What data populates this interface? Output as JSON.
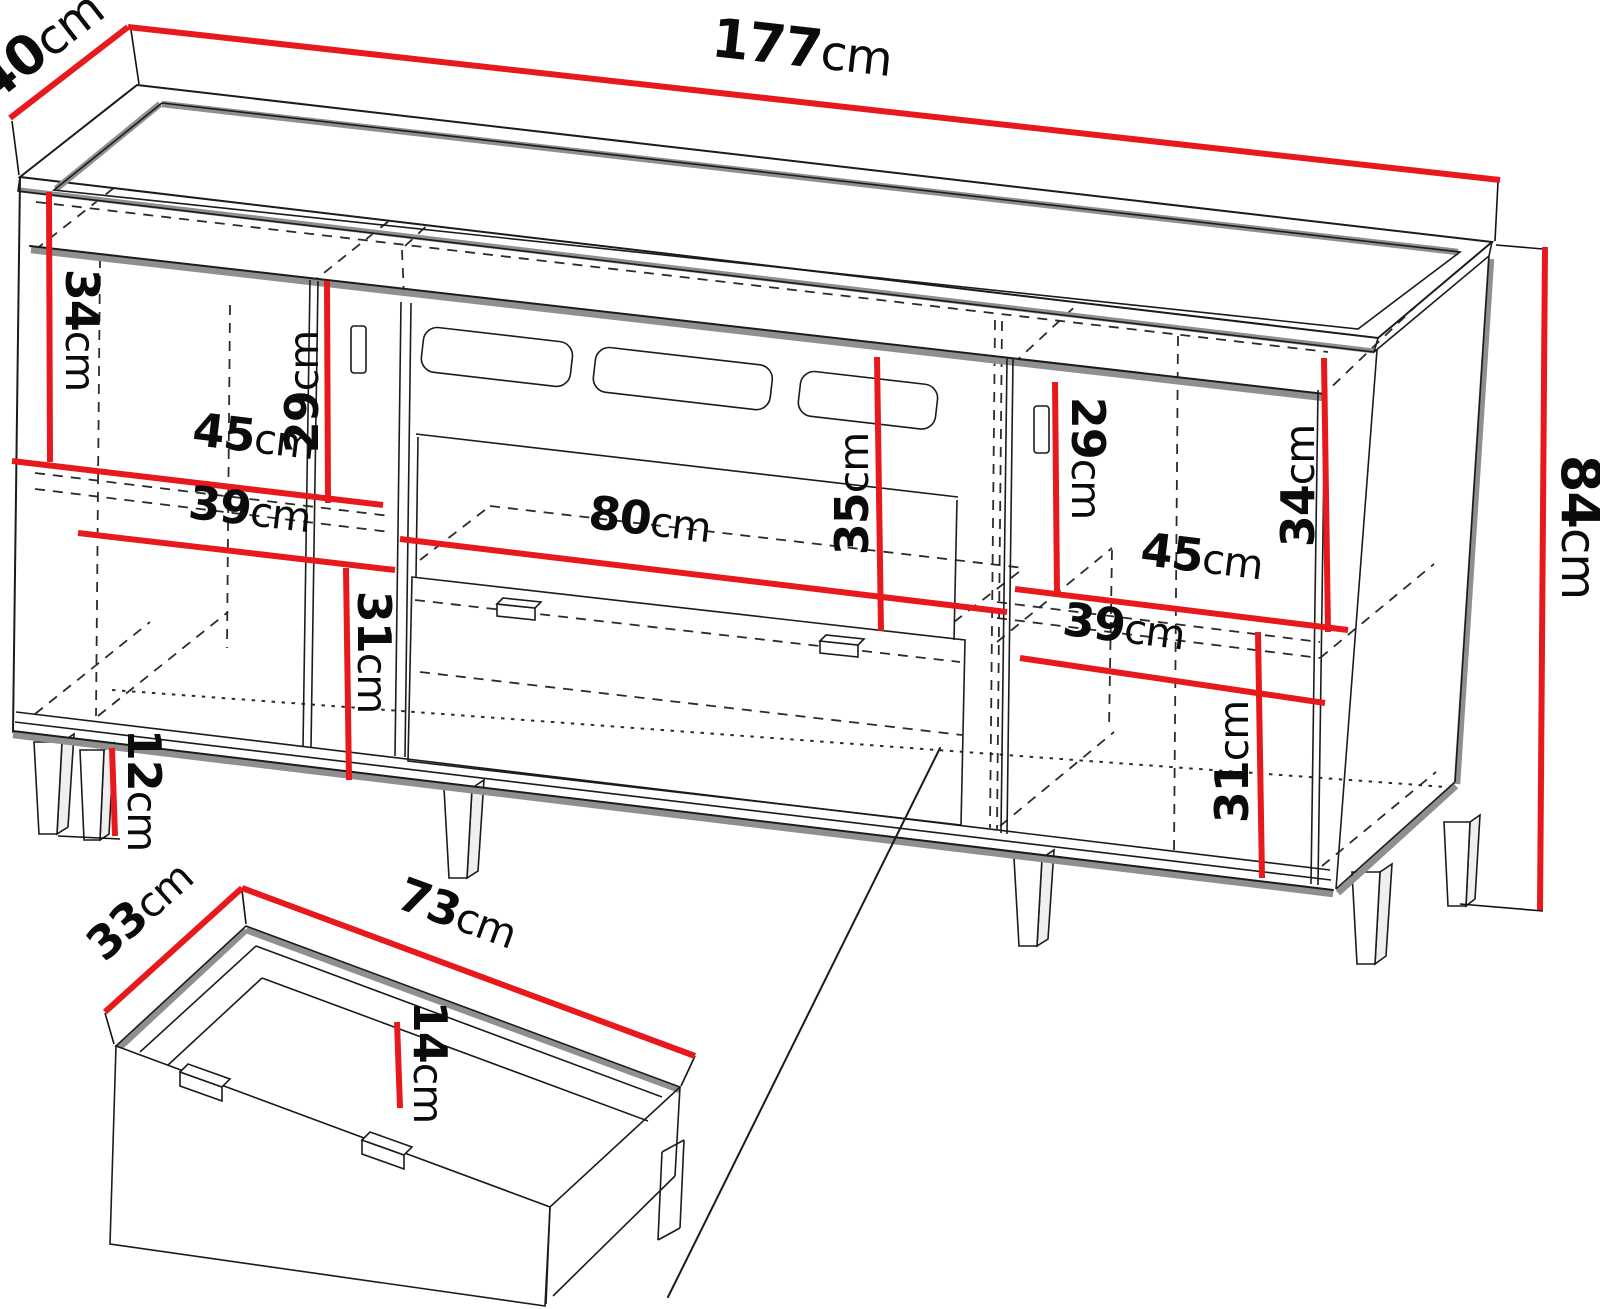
{
  "page": {
    "background": "#ffffff"
  },
  "diagram": {
    "type": "furniture-dimension-drawing",
    "subject": "sideboard with three sections, slatted media niche and pull-out drawer detail",
    "accent_color": "#e8191d",
    "outline_color": "#1b1b1b",
    "shade_color": "#8f8f8f",
    "labels": {
      "width": {
        "value": "177",
        "unit": "cm"
      },
      "depth": {
        "value": "40",
        "unit": "cm"
      },
      "height": {
        "value": "84",
        "unit": "cm"
      },
      "left_top_clearance": {
        "value": "34",
        "unit": "cm"
      },
      "left_upper_shelf_height": {
        "value": "29",
        "unit": "cm"
      },
      "left_width_upper": {
        "value": "45",
        "unit": "cm"
      },
      "left_width_lower": {
        "value": "39",
        "unit": "cm"
      },
      "left_lower_shelf_height": {
        "value": "31",
        "unit": "cm"
      },
      "leg_height": {
        "value": "12",
        "unit": "cm"
      },
      "niche_width": {
        "value": "80",
        "unit": "cm"
      },
      "niche_height": {
        "value": "35",
        "unit": "cm"
      },
      "right_upper_shelf_height": {
        "value": "29",
        "unit": "cm"
      },
      "right_top_clearance": {
        "value": "34",
        "unit": "cm"
      },
      "right_width_upper": {
        "value": "45",
        "unit": "cm"
      },
      "right_width_lower": {
        "value": "39",
        "unit": "cm"
      },
      "right_lower_shelf_height": {
        "value": "31",
        "unit": "cm"
      },
      "drawer_width": {
        "value": "73",
        "unit": "cm"
      },
      "drawer_depth": {
        "value": "33",
        "unit": "cm"
      },
      "drawer_inner_height": {
        "value": "14",
        "unit": "cm"
      }
    }
  }
}
